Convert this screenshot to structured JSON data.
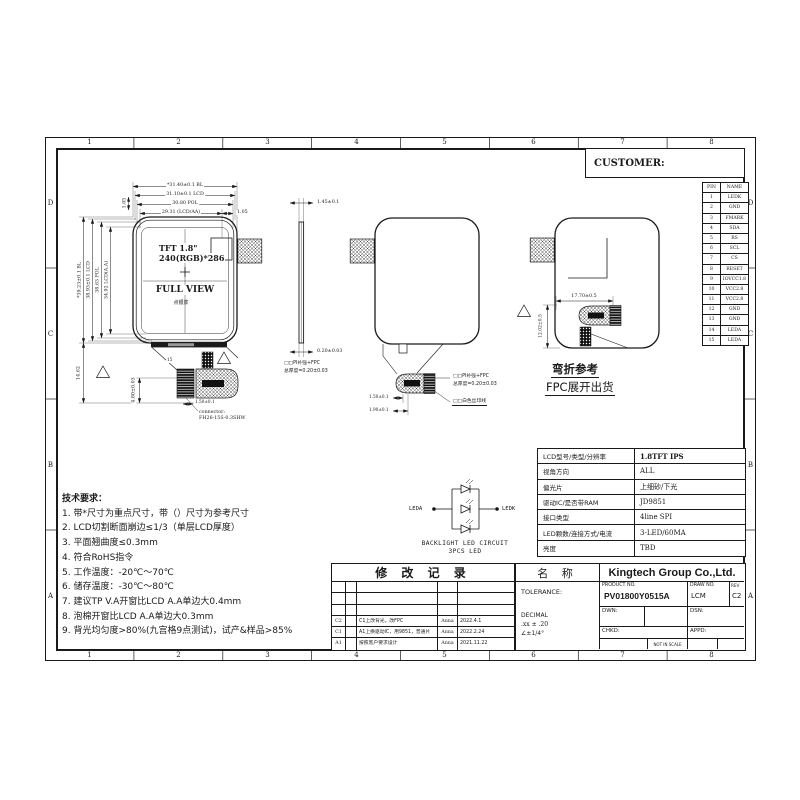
{
  "frame": {
    "cols": [
      "1",
      "2",
      "3",
      "4",
      "5",
      "6",
      "7",
      "8"
    ],
    "rows": [
      "D",
      "C",
      "B",
      "A"
    ]
  },
  "customer": {
    "label": "CUSTOMER:"
  },
  "pin_table": {
    "col_pin": "PIN",
    "col_name": "NAME",
    "rows": [
      {
        "pin": "1",
        "name": "LEDK"
      },
      {
        "pin": "2",
        "name": "GND"
      },
      {
        "pin": "3",
        "name": "FMARK"
      },
      {
        "pin": "4",
        "name": "SDA"
      },
      {
        "pin": "5",
        "name": "RS"
      },
      {
        "pin": "6",
        "name": "SCL"
      },
      {
        "pin": "7",
        "name": "CS"
      },
      {
        "pin": "8",
        "name": "RESET"
      },
      {
        "pin": "9",
        "name": "IOVCC1.8"
      },
      {
        "pin": "10",
        "name": "VCC2.8"
      },
      {
        "pin": "11",
        "name": "VCC2.8"
      },
      {
        "pin": "12",
        "name": "GND"
      },
      {
        "pin": "13",
        "name": "GND"
      },
      {
        "pin": "14",
        "name": "LEDA"
      },
      {
        "pin": "15",
        "name": "LEDA"
      }
    ]
  },
  "front_view": {
    "title": "TFT 1.8\"",
    "resolution": "240(RGB)*286",
    "caption": "FULL VIEW",
    "glue_note": "点银浆",
    "dim_bl_w": "*31.40±0.1 BL",
    "dim_lcd_w": "31.10±0.1 LCD",
    "dim_pol_w": "30.80 POL",
    "dim_aa_w": "29.31 (LCD/AA)",
    "dim_offset_r": "1.05",
    "dim_offset_t": "1.05",
    "dim_bl_h": "*39.23±0.1 BL",
    "dim_lcd_h": "38.93±0.1 LCD",
    "dim_pol_h": "38.63 POL",
    "dim_aa_h": "34.92 LCD(A.A)",
    "dim_tail": "14.62",
    "dim_conn_h": "4.80±0.03",
    "dim_conn_w": "1.50±0.1",
    "pin15": "15",
    "connector_label1": "connector:",
    "connector_label2": "FH26-15S-0.3SHW"
  },
  "side_view": {
    "dim_thk": "1.45±0.1",
    "dim_fpc": "0.20±0.03",
    "note1": "□□PI补强+FPC",
    "note2": "总厚度=0.20±0.03"
  },
  "back_view": {
    "note1": "□□PI补强+FPC",
    "note2": "总厚度=0.20±0.03",
    "note3": "□□白色丝印线",
    "dim1": "1.50±0.1",
    "dim2": "1.90±0.1"
  },
  "bend_view": {
    "dim_w": "17.70±0.5",
    "dim_h": "12.02±0.5",
    "title": "弯折参考",
    "subtitle": "FPC展开出货"
  },
  "led_circuit": {
    "left": "LEDA",
    "right": "LEDK",
    "caption1": "BACKLIGHT LED CIRCUIT",
    "caption2": "3PCS LED"
  },
  "spec_table": {
    "rows": [
      {
        "label": "LCD型号/类型/分辨率",
        "value": "1.8TFT IPS"
      },
      {
        "label": "视角方向",
        "value": "ALL"
      },
      {
        "label": "偏光片",
        "value": "上细砂/下光"
      },
      {
        "label": "驱动IC/是否带RAM",
        "value": "JD9851"
      },
      {
        "label": "接口类型",
        "value": "4line SPI"
      },
      {
        "label": "LED颗数/连接方式/电流",
        "value": "3-LED/60MA"
      },
      {
        "label": "亮度",
        "value": "TBD"
      }
    ]
  },
  "tech_requirements": {
    "title": "技术要求：",
    "items": [
      "1.  带*尺寸为重点尺寸，带（）尺寸为参考尺寸",
      "2.  LCD切割断面崩边≤1/3（单层LCD厚度）",
      "3.  平面翘曲度≤0.3mm",
      "4.  符合RoHS指令",
      "5.  工作温度：-20℃～70℃",
      "6.  储存温度：-30℃～80℃",
      "7.  建议TP V.A开窗比LCD A.A单边大0.4mm",
      "8.  泡棉开窗比LCD A.A单边大0.3mm",
      "9.  背光均匀度>80%(九宫格9点测试)，试产&样品>85%"
    ]
  },
  "revision_table": {
    "title": "修 改 记 录",
    "rows": [
      {
        "rev": "C2",
        "desc": "C1上改背光，改FPC",
        "by": "Anna",
        "date": "2022.4.1"
      },
      {
        "rev": "C1",
        "desc": "A1上换驱动IC，用9851，普通片",
        "by": "Anna",
        "date": "2022.2.24"
      },
      {
        "rev": "A1",
        "desc": "按照客户要求设计",
        "by": "Anna",
        "date": "2021.11.22"
      }
    ]
  },
  "title_block": {
    "name_label": "名 称",
    "company": "Kingtech Group Co.,Ltd.",
    "tolerance_label": "TOLERANCE:",
    "decimal_label": "DECIMAL",
    "decimal_tol": ".xx ± .20",
    "angle_tol": "∠±1/4°",
    "product_no_label": "PRODUCT NO.",
    "product_no": "PV01800Y0515A",
    "draw_no_label": "DRAW NO.",
    "draw_no": "LCM",
    "rev_label": "REV",
    "rev": "C2",
    "dwn_label": "DWN:",
    "dsn_label": "DSN:",
    "chkd_label": "CHKD:",
    "appd_label": "APPD:",
    "scale_note": "NOT IN SCALE",
    "unit_label": "UNIT:",
    "unit": "mm",
    "sheet_label": "SHEET:",
    "sheet": "1-1"
  }
}
